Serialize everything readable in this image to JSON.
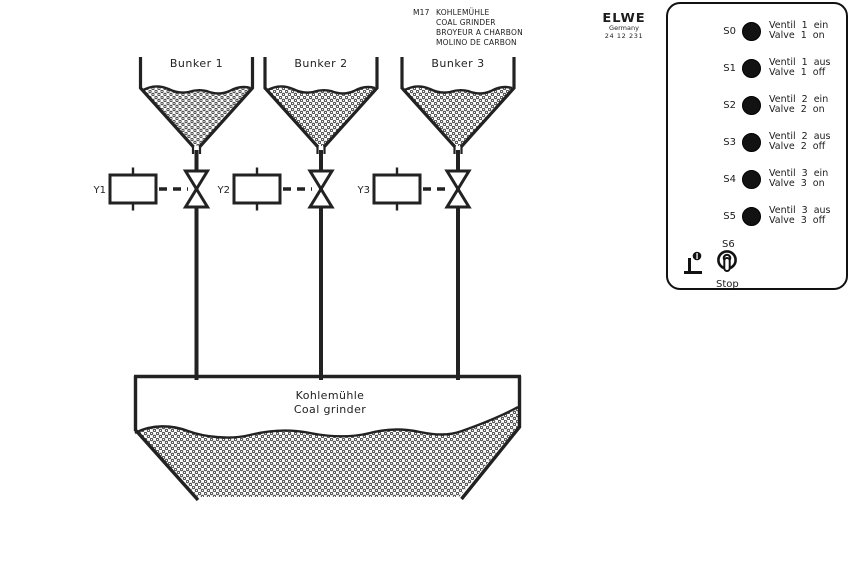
{
  "header": {
    "designation": "M17",
    "titles": {
      "de": "KOHLEMÜHLE",
      "en": "COAL GRINDER",
      "fr": "BROYEUR A CHARBON",
      "es": "MOLINO DE CARBON"
    }
  },
  "logo": {
    "brand": "ELWE",
    "country": "Germany",
    "code": "24 12 231"
  },
  "diagram": {
    "bunkers": [
      {
        "label": "Bunker 1"
      },
      {
        "label": "Bunker 2"
      },
      {
        "label": "Bunker 3"
      }
    ],
    "valves": [
      {
        "label": "Y1"
      },
      {
        "label": "Y2"
      },
      {
        "label": "Y3"
      }
    ],
    "grinder": {
      "label_de": "Kohlemühle",
      "label_en": "Coal grinder"
    }
  },
  "panel": {
    "buttons": [
      {
        "id": "S0",
        "line1": "Ventil 1 ein",
        "line2": "Valve 1 on"
      },
      {
        "id": "S1",
        "line1": "Ventil 1 aus",
        "line2": "Valve 1 off"
      },
      {
        "id": "S2",
        "line1": "Ventil 2 ein",
        "line2": "Valve 2 on"
      },
      {
        "id": "S3",
        "line1": "Ventil 2 aus",
        "line2": "Valve 2 off"
      },
      {
        "id": "S4",
        "line1": "Ventil 3 ein",
        "line2": "Valve 3 on"
      },
      {
        "id": "S5",
        "line1": "Ventil 3 aus",
        "line2": "Valve 3 off"
      }
    ],
    "stop_switch": {
      "id": "S6",
      "label": "Stop"
    }
  },
  "colors": {
    "line": "#222222",
    "button": "#121212",
    "background": "#ffffff"
  }
}
